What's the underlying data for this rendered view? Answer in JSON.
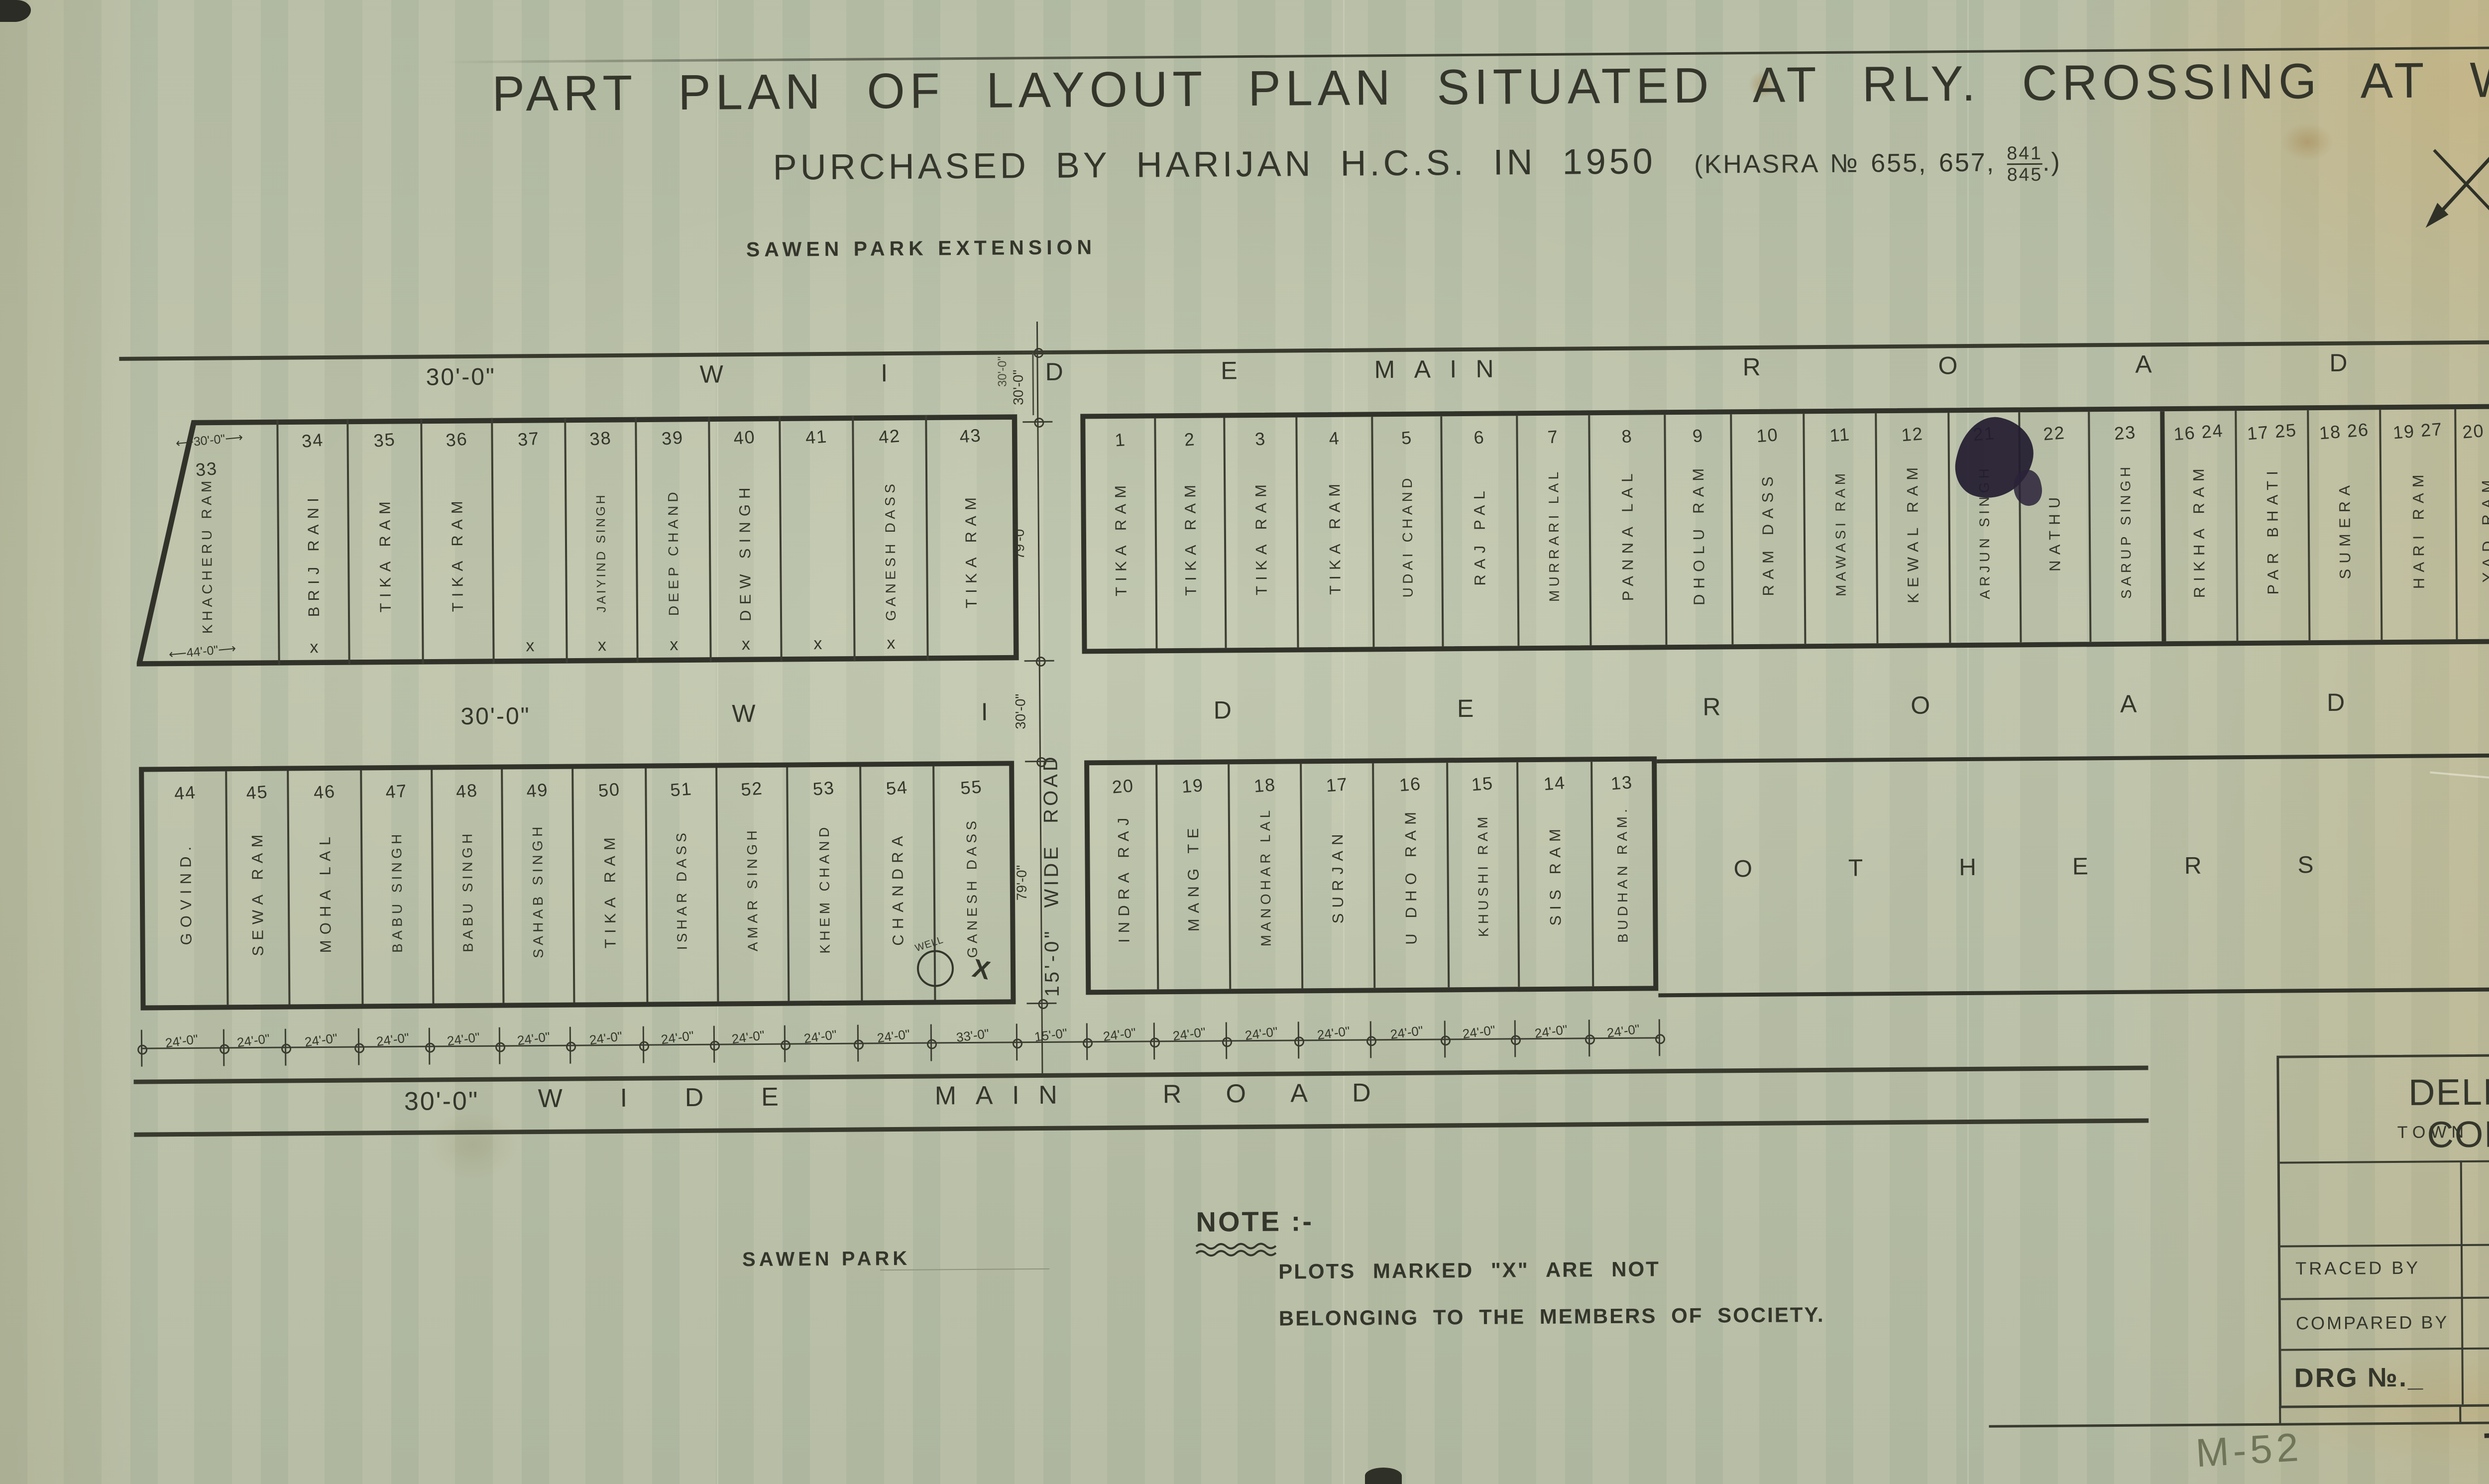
{
  "colors": {
    "ink": "#34362b",
    "blue_ink": "#5a66b4",
    "violet_ink": "#6b5fb0",
    "pencil": "#6a7158",
    "paper": "#b9bfa8"
  },
  "sheet": {
    "title_line1": "PART PLAN OF LAYOUT PLAN SITUATED AT RLY. CROSSING AT WAZIR PUR. ROAD DELHI.",
    "title_line2": "PURCHASED BY HARIJAN H.C.S. IN 1950",
    "khasra_prefix": "(KHASRA № 655, 657,",
    "khasra_fraction_top": "841",
    "khasra_fraction_bottom": "845",
    "khasra_suffix": ".)",
    "corner_ref": "M/20",
    "edge_ref": "W-25",
    "footer_left": "M-52",
    "footer_right": "TP/M/5052.",
    "footer_blue_note": "21)"
  },
  "labels": {
    "sawen_park_extension": "SAWEN PARK EXTENSION",
    "sawen_park": "SAWEN PARK",
    "others_word1": "OTHERS",
    "others_word2": "PLOTS."
  },
  "glyphs": {
    "x_mark": "x",
    "well_label": "WELL"
  },
  "roads": {
    "top": {
      "dim": "30'-0\"",
      "words": [
        "WIDE",
        "MAIN",
        "ROAD"
      ],
      "cross_dim": "30'-0\""
    },
    "middle": {
      "dim": "30'-0\"",
      "words": [
        "WIDE",
        "ROAD"
      ]
    },
    "bottom": {
      "dim": "30'-0\"",
      "words": [
        "WIDE",
        "MAIN",
        "ROAD"
      ]
    },
    "vertical": {
      "label": "15'-0\"  WIDE ROAD"
    }
  },
  "blocks": {
    "top_left": {
      "plots": [
        {
          "no": "33",
          "name": "KHACHERU RAM",
          "marked": false,
          "dim_top": "30'-0\"",
          "dim_bottom": "44'-0\""
        },
        {
          "no": "34",
          "name": "BRIJ RANI",
          "marked": true
        },
        {
          "no": "35",
          "name": "TIKA RAM",
          "marked": false
        },
        {
          "no": "36",
          "name": "TIKA RAM",
          "marked": false
        },
        {
          "no": "37",
          "name": "",
          "marked": true
        },
        {
          "no": "38",
          "name": "JAIYIND SINGH",
          "marked": true
        },
        {
          "no": "39",
          "name": "DEEP CHAND",
          "marked": true
        },
        {
          "no": "40",
          "name": "DEW SINGH",
          "marked": true
        },
        {
          "no": "41",
          "name": "",
          "marked": true
        },
        {
          "no": "42",
          "name": "GANESH DASS",
          "marked": true
        },
        {
          "no": "43",
          "name": "TIKA RAM",
          "marked": false
        }
      ]
    },
    "top_right": {
      "plots": [
        {
          "no": "1",
          "name": "TIKA RAM",
          "marked": false
        },
        {
          "no": "2",
          "name": "TIKA RAM",
          "marked": false
        },
        {
          "no": "3",
          "name": "TIKA RAM",
          "marked": false
        },
        {
          "no": "4",
          "name": "TIKA RAM",
          "marked": false
        },
        {
          "no": "5",
          "name": "UDAI CHAND",
          "marked": false
        },
        {
          "no": "6",
          "name": "RAJ PAL",
          "marked": false
        },
        {
          "no": "7",
          "name": "MURRARI LAL",
          "marked": false
        },
        {
          "no": "8",
          "name": "PANNA LAL",
          "marked": false
        },
        {
          "no": "9",
          "name": "DHOLU RAM",
          "marked": false
        },
        {
          "no": "10",
          "name": "RAM DASS",
          "marked": false
        },
        {
          "no": "11",
          "name": "MAWASI RAM",
          "marked": false
        },
        {
          "no": "12",
          "name": "KEWAL RAM",
          "marked": false
        },
        {
          "no": "21",
          "name": "ARJUN SINGH",
          "marked": false
        },
        {
          "no": "22",
          "name": "NATHU",
          "marked": false
        },
        {
          "no": "23",
          "name": "SARUP SINGH",
          "marked": false
        },
        {
          "no": "16 24",
          "name": "RIKHA RAM",
          "marked": false
        },
        {
          "no": "17 25",
          "name": "PAR BHATI",
          "marked": false
        },
        {
          "no": "18 26",
          "name": "SUMERA",
          "marked": false
        },
        {
          "no": "19 27",
          "name": "HARI RAM",
          "marked": false
        },
        {
          "no": "20 28",
          "name": "YAD RAM",
          "marked": false
        },
        {
          "no": "21 29",
          "name": "BANARSI DASS",
          "marked": false
        },
        {
          "no": "22 30",
          "name": "GHASI RAM",
          "marked": true
        },
        {
          "no": "31",
          "name": "TEJU",
          "marked": false
        },
        {
          "no": "",
          "name": "RAM LAL BHAGAT RAM.",
          "marked": false
        }
      ]
    },
    "bottom_left": {
      "plots": [
        {
          "no": "44",
          "name": "GOVIND.",
          "marked": false
        },
        {
          "no": "45",
          "name": "SEWA RAM",
          "marked": false
        },
        {
          "no": "46",
          "name": "MOHA LAL",
          "marked": false
        },
        {
          "no": "47",
          "name": "BABU SINGH",
          "marked": false
        },
        {
          "no": "48",
          "name": "BABU SINGH",
          "marked": false
        },
        {
          "no": "49",
          "name": "SAHAB SINGH",
          "marked": false
        },
        {
          "no": "50",
          "name": "TIKA RAM",
          "marked": false
        },
        {
          "no": "51",
          "name": "ISHAR DASS",
          "marked": false
        },
        {
          "no": "52",
          "name": "AMAR SINGH",
          "marked": false
        },
        {
          "no": "53",
          "name": "KHEM CHAND",
          "marked": false
        },
        {
          "no": "54",
          "name": "CHANDRA",
          "marked": false
        },
        {
          "no": "55",
          "name": "GANESH DASS",
          "marked": true,
          "well": true
        }
      ]
    },
    "bottom_middle": {
      "plots": [
        {
          "no": "20",
          "name": "INDRA RAJ",
          "marked": false
        },
        {
          "no": "19",
          "name": "MANG TE",
          "marked": false
        },
        {
          "no": "18",
          "name": "MANOHAR LAL",
          "marked": false
        },
        {
          "no": "17",
          "name": "SURJAN",
          "marked": false
        },
        {
          "no": "16",
          "name": "U DHO RAM",
          "marked": false
        },
        {
          "no": "15",
          "name": "KHUSHI RAM",
          "marked": false
        },
        {
          "no": "14",
          "name": "SIS RAM",
          "marked": false
        },
        {
          "no": "13",
          "name": "BUDHAN RAM.",
          "marked": false
        }
      ]
    }
  },
  "dimensions": {
    "chain": [
      "24'-0\"",
      "24'-0\"",
      "24'-0\"",
      "24'-0\"",
      "24'-0\"",
      "24'-0\"",
      "24'-0\"",
      "24'-0\"",
      "24'-0\"",
      "24'-0\"",
      "24'-0\"",
      "33'-0\"",
      "15'-0\"",
      "24'-0\"",
      "24'-0\"",
      "24'-0\"",
      "24'-0\"",
      "24'-0\"",
      "24'-0\"",
      "24'-0\"",
      "24'-0\""
    ],
    "vertical": [
      "30'-0\"",
      "79'-0\"",
      "30'-0\"",
      "79'-0\""
    ]
  },
  "note": {
    "heading": "NOTE :-",
    "line1": "PLOTS MARKED \"X\" ARE NOT",
    "line2": "BELONGING TO THE MEMBERS OF SOCIETY."
  },
  "title_block": {
    "org": "DELHI MUNCIPAL CORPORATION.",
    "section": "TOWN PLANNING SECTION",
    "town_planner_label": "TOWN PLANNER.",
    "traced_by_label": "TRACED BY",
    "traced_by_value": "HARNAM DASS 4.3.60",
    "compared_by_label": "COMPARED BY",
    "compared_by_value": "J.K. JAIN.",
    "drg_label": "DRG №._",
    "drg_value": "T.P.C/M/20"
  }
}
